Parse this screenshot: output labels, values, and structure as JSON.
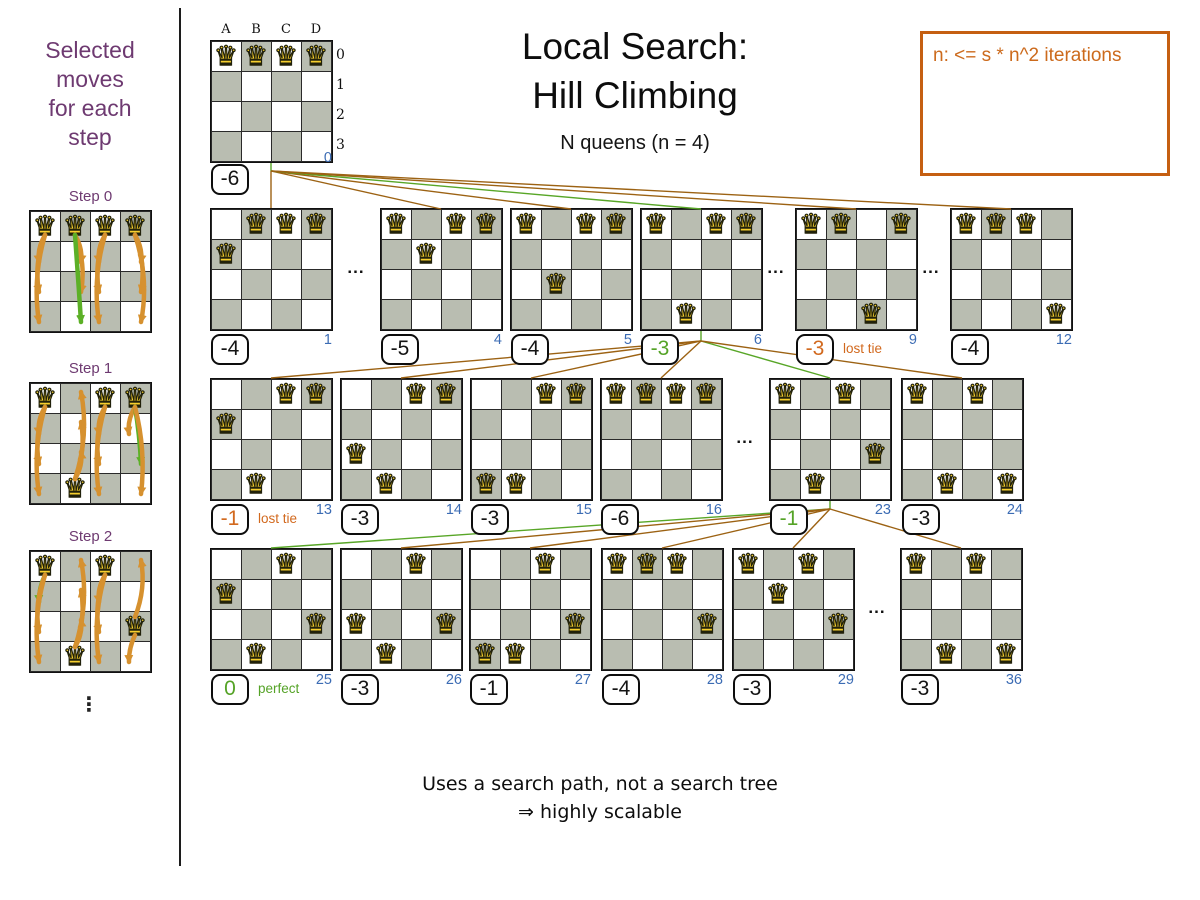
{
  "header": {
    "title_line1": "Local Search:",
    "title_line2": "Hill Climbing",
    "subtitle": "N queens (n = 4)"
  },
  "note_box": {
    "text": "n: <= s * n^2 iterations"
  },
  "left_panel": {
    "heading_lines": [
      "Selected",
      "moves",
      "for each",
      "step"
    ],
    "ellipsis": "⋮",
    "steps": [
      {
        "label": "Step 0",
        "x": 29,
        "y": 210,
        "queens": [
          [
            0,
            0
          ],
          [
            1,
            0
          ],
          [
            2,
            0
          ],
          [
            3,
            0
          ]
        ],
        "arrows": [
          [
            0,
            0,
            1,
            -5,
            "o"
          ],
          [
            0,
            0,
            2,
            -7,
            "o"
          ],
          [
            0,
            0,
            3,
            -8,
            "o"
          ],
          [
            1,
            0,
            1,
            5,
            "o"
          ],
          [
            1,
            0,
            2,
            7,
            "o"
          ],
          [
            1,
            0,
            3,
            2,
            "g"
          ],
          [
            2,
            0,
            1,
            -5,
            "o"
          ],
          [
            2,
            0,
            2,
            -7,
            "o"
          ],
          [
            2,
            0,
            3,
            -8,
            "o"
          ],
          [
            3,
            0,
            1,
            5,
            "o"
          ],
          [
            3,
            0,
            2,
            7,
            "o"
          ],
          [
            3,
            0,
            3,
            9,
            "o"
          ]
        ]
      },
      {
        "label": "Step 1",
        "x": 29,
        "y": 382,
        "queens": [
          [
            0,
            0
          ],
          [
            2,
            0
          ],
          [
            3,
            0
          ],
          [
            1,
            3
          ]
        ],
        "arrows": [
          [
            0,
            0,
            1,
            -5,
            "o"
          ],
          [
            0,
            0,
            2,
            -7,
            "o"
          ],
          [
            0,
            0,
            3,
            -8,
            "o"
          ],
          [
            1,
            3,
            2,
            5,
            "o"
          ],
          [
            1,
            3,
            1,
            7,
            "o"
          ],
          [
            1,
            3,
            0,
            9,
            "o"
          ],
          [
            2,
            0,
            1,
            -5,
            "o"
          ],
          [
            2,
            0,
            2,
            -7,
            "o"
          ],
          [
            2,
            0,
            3,
            -8,
            "o"
          ],
          [
            3,
            0,
            1,
            -5,
            "o"
          ],
          [
            3,
            0,
            2,
            3,
            "g"
          ],
          [
            3,
            0,
            3,
            7,
            "o"
          ]
        ]
      },
      {
        "label": "Step 2",
        "x": 29,
        "y": 550,
        "queens": [
          [
            0,
            0
          ],
          [
            2,
            0
          ],
          [
            3,
            2
          ],
          [
            1,
            3
          ]
        ],
        "arrows": [
          [
            0,
            0,
            1,
            -4,
            "g"
          ],
          [
            0,
            0,
            2,
            -7,
            "o"
          ],
          [
            0,
            0,
            3,
            -8,
            "o"
          ],
          [
            1,
            3,
            2,
            5,
            "o"
          ],
          [
            1,
            3,
            1,
            7,
            "o"
          ],
          [
            1,
            3,
            0,
            9,
            "o"
          ],
          [
            2,
            0,
            1,
            -5,
            "o"
          ],
          [
            2,
            0,
            2,
            -7,
            "o"
          ],
          [
            2,
            0,
            3,
            -8,
            "o"
          ],
          [
            3,
            2,
            0,
            7,
            "o"
          ],
          [
            3,
            2,
            3,
            -4,
            "o"
          ]
        ]
      }
    ]
  },
  "footer": {
    "line1": "Uses a search path, not a search tree",
    "line2": "⇒ highly scalable"
  },
  "board_labels": {
    "columns": [
      "A",
      "B",
      "C",
      "D"
    ],
    "rows": [
      "0",
      "1",
      "2",
      "3"
    ]
  },
  "root_board": {
    "x": 210,
    "y": 40,
    "queens": [
      [
        0,
        0
      ],
      [
        1,
        0
      ],
      [
        2,
        0
      ],
      [
        3,
        0
      ]
    ],
    "score": "-6",
    "score_style": "black",
    "index": "0"
  },
  "tree": {
    "row_tops": {
      "1": 208,
      "2": 378,
      "3": 548
    },
    "dots_char": "...",
    "dots": [
      {
        "x": 356,
        "y": 268
      },
      {
        "x": 776,
        "y": 268
      },
      {
        "x": 931,
        "y": 268
      },
      {
        "x": 745,
        "y": 438
      },
      {
        "x": 877,
        "y": 608
      }
    ],
    "boards": [
      {
        "id": "1",
        "x": 210,
        "row": 1,
        "queens": [
          [
            1,
            0
          ],
          [
            2,
            0
          ],
          [
            3,
            0
          ],
          [
            0,
            1
          ]
        ],
        "score": "-4",
        "score_style": "black",
        "index": "1"
      },
      {
        "id": "4",
        "x": 380,
        "row": 1,
        "queens": [
          [
            0,
            0
          ],
          [
            2,
            0
          ],
          [
            3,
            0
          ],
          [
            1,
            1
          ]
        ],
        "score": "-5",
        "score_style": "black",
        "index": "4"
      },
      {
        "id": "5",
        "x": 510,
        "row": 1,
        "queens": [
          [
            0,
            0
          ],
          [
            2,
            0
          ],
          [
            3,
            0
          ],
          [
            1,
            2
          ]
        ],
        "score": "-4",
        "score_style": "black",
        "index": "5"
      },
      {
        "id": "6",
        "x": 640,
        "row": 1,
        "queens": [
          [
            0,
            0
          ],
          [
            2,
            0
          ],
          [
            3,
            0
          ],
          [
            1,
            3
          ]
        ],
        "score": "-3",
        "score_style": "green",
        "index": "6"
      },
      {
        "id": "9",
        "x": 795,
        "row": 1,
        "queens": [
          [
            0,
            0
          ],
          [
            1,
            0
          ],
          [
            3,
            0
          ],
          [
            2,
            3
          ]
        ],
        "score": "-3",
        "score_style": "orange",
        "index": "9",
        "tag": "lost tie",
        "tag_style": "orange"
      },
      {
        "id": "12",
        "x": 950,
        "row": 1,
        "queens": [
          [
            0,
            0
          ],
          [
            1,
            0
          ],
          [
            2,
            0
          ],
          [
            3,
            3
          ]
        ],
        "score": "-4",
        "score_style": "black",
        "index": "12"
      },
      {
        "id": "13",
        "x": 210,
        "row": 2,
        "queens": [
          [
            2,
            0
          ],
          [
            3,
            0
          ],
          [
            0,
            1
          ],
          [
            1,
            3
          ]
        ],
        "score": "-1",
        "score_style": "orange",
        "index": "13",
        "tag": "lost tie",
        "tag_style": "orange"
      },
      {
        "id": "14",
        "x": 340,
        "row": 2,
        "queens": [
          [
            2,
            0
          ],
          [
            3,
            0
          ],
          [
            0,
            2
          ],
          [
            1,
            3
          ]
        ],
        "score": "-3",
        "score_style": "black",
        "index": "14"
      },
      {
        "id": "15",
        "x": 470,
        "row": 2,
        "queens": [
          [
            2,
            0
          ],
          [
            3,
            0
          ],
          [
            0,
            3
          ],
          [
            1,
            3
          ]
        ],
        "score": "-3",
        "score_style": "black",
        "index": "15"
      },
      {
        "id": "16",
        "x": 600,
        "row": 2,
        "queens": [
          [
            0,
            0
          ],
          [
            1,
            0
          ],
          [
            2,
            0
          ],
          [
            3,
            0
          ]
        ],
        "score": "-6",
        "score_style": "black",
        "index": "16"
      },
      {
        "id": "23",
        "x": 769,
        "row": 2,
        "queens": [
          [
            0,
            0
          ],
          [
            2,
            0
          ],
          [
            3,
            2
          ],
          [
            1,
            3
          ]
        ],
        "score": "-1",
        "score_style": "green",
        "index": "23"
      },
      {
        "id": "24",
        "x": 901,
        "row": 2,
        "queens": [
          [
            0,
            0
          ],
          [
            2,
            0
          ],
          [
            1,
            3
          ],
          [
            3,
            3
          ]
        ],
        "score": "-3",
        "score_style": "black",
        "index": "24"
      },
      {
        "id": "25",
        "x": 210,
        "row": 3,
        "queens": [
          [
            2,
            0
          ],
          [
            0,
            1
          ],
          [
            3,
            2
          ],
          [
            1,
            3
          ]
        ],
        "score": "0",
        "score_style": "green",
        "index": "25",
        "tag": "perfect",
        "tag_style": "green"
      },
      {
        "id": "26",
        "x": 340,
        "row": 3,
        "queens": [
          [
            2,
            0
          ],
          [
            0,
            2
          ],
          [
            3,
            2
          ],
          [
            1,
            3
          ]
        ],
        "score": "-3",
        "score_style": "black",
        "index": "26"
      },
      {
        "id": "27",
        "x": 469,
        "row": 3,
        "queens": [
          [
            2,
            0
          ],
          [
            3,
            2
          ],
          [
            0,
            3
          ],
          [
            1,
            3
          ]
        ],
        "score": "-1",
        "score_style": "black",
        "index": "27"
      },
      {
        "id": "28",
        "x": 601,
        "row": 3,
        "queens": [
          [
            0,
            0
          ],
          [
            1,
            0
          ],
          [
            2,
            0
          ],
          [
            3,
            2
          ]
        ],
        "score": "-4",
        "score_style": "black",
        "index": "28"
      },
      {
        "id": "29",
        "x": 732,
        "row": 3,
        "queens": [
          [
            0,
            0
          ],
          [
            2,
            0
          ],
          [
            1,
            1
          ],
          [
            3,
            2
          ]
        ],
        "score": "-3",
        "score_style": "black",
        "index": "29"
      },
      {
        "id": "36",
        "x": 900,
        "row": 3,
        "queens": [
          [
            0,
            0
          ],
          [
            2,
            0
          ],
          [
            1,
            3
          ],
          [
            3,
            3
          ]
        ],
        "score": "-3",
        "score_style": "black",
        "index": "36"
      }
    ]
  },
  "connectors": [
    [
      271,
      163,
      271,
      171,
      "g"
    ],
    [
      271,
      171,
      271,
      208,
      "o"
    ],
    [
      271,
      171,
      441,
      209,
      "o"
    ],
    [
      271,
      171,
      571,
      209,
      "o"
    ],
    [
      271,
      171,
      701,
      209,
      "g"
    ],
    [
      271,
      171,
      856,
      209,
      "o"
    ],
    [
      271,
      171,
      1011,
      209,
      "o"
    ],
    [
      701,
      331,
      701,
      341,
      "g"
    ],
    [
      701,
      341,
      271,
      378,
      "o"
    ],
    [
      701,
      341,
      401,
      378,
      "o"
    ],
    [
      701,
      341,
      531,
      378,
      "o"
    ],
    [
      701,
      341,
      661,
      378,
      "o"
    ],
    [
      701,
      341,
      830,
      378,
      "g"
    ],
    [
      701,
      341,
      962,
      378,
      "o"
    ],
    [
      830,
      501,
      830,
      509,
      "g"
    ],
    [
      830,
      509,
      271,
      548,
      "g"
    ],
    [
      830,
      509,
      401,
      548,
      "o"
    ],
    [
      830,
      509,
      530,
      548,
      "o"
    ],
    [
      830,
      509,
      662,
      548,
      "o"
    ],
    [
      830,
      509,
      793,
      548,
      "o"
    ],
    [
      830,
      509,
      961,
      548,
      "o"
    ]
  ],
  "colors": {
    "line_orange": "#9c6213",
    "line_green": "#58a627",
    "arrow_orange": "#d6912f",
    "arrow_green": "#5cb027",
    "purple": "#6e3a71",
    "index_blue": "#3c6cb4",
    "score_green": "#55a327",
    "score_orange": "#d2691e",
    "cell_gray": "#b9bdb1",
    "queen_yellow": "#f6cf2e",
    "note_orange": "#cc6a1c"
  }
}
